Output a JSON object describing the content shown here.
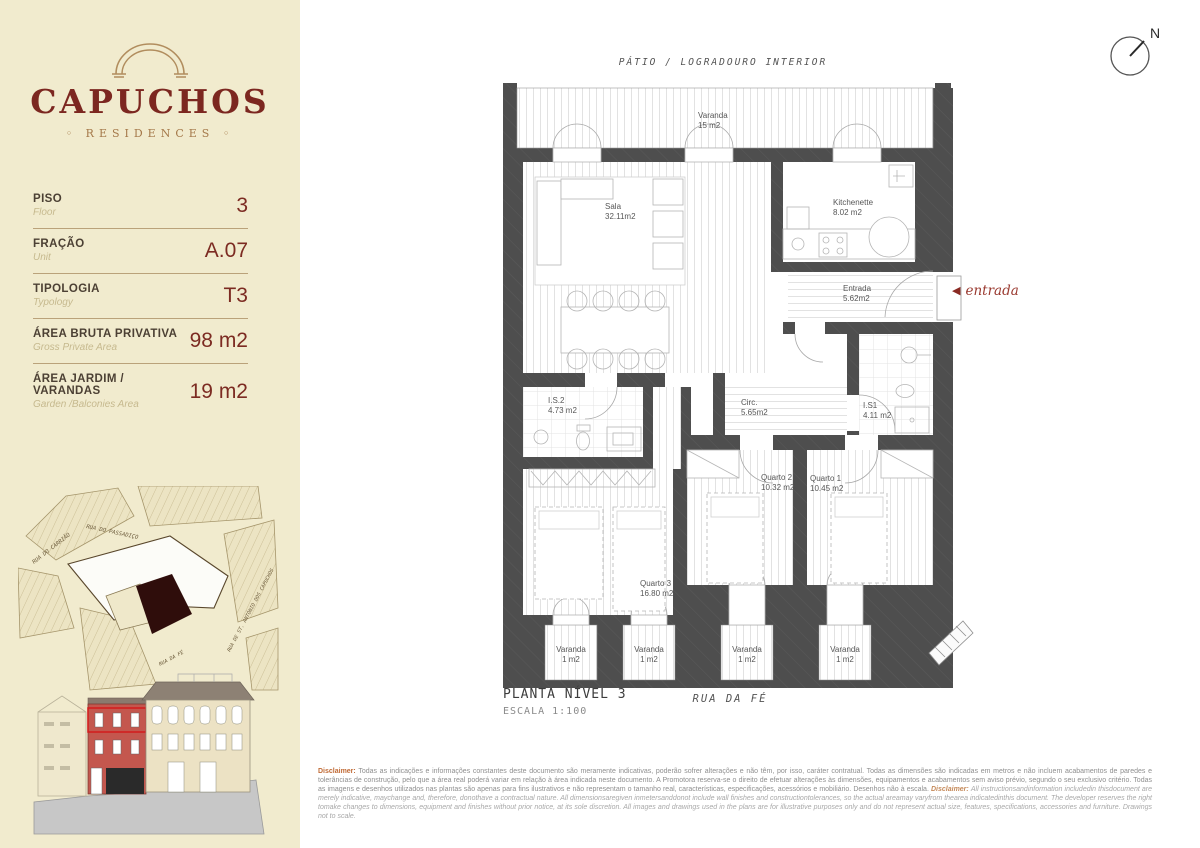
{
  "brand": {
    "name": "CAPUCHOS",
    "subtitle": "◦ RESIDENCES ◦"
  },
  "sidebar": {
    "fields": [
      {
        "label": "PISO",
        "sublabel": "Floor",
        "value": "3"
      },
      {
        "label": "FRAÇÃO",
        "sublabel": "Unit",
        "value": "A.07"
      },
      {
        "label": "TIPOLOGIA",
        "sublabel": "Typology",
        "value": "T3"
      },
      {
        "label": "ÁREA BRUTA PRIVATIVA",
        "sublabel": "Gross Private Area",
        "value": "98 m2"
      },
      {
        "label": "ÁREA JARDIM / VARANDAS",
        "sublabel": "Garden /Balconies Area",
        "value": "19 m2"
      }
    ],
    "map": {
      "streets": [
        "RUA DO CARRIÃO",
        "RUA DO PASSADIÇO",
        "RUA DE ST. ANTÓNIO DOS CAPUCHOS",
        "RUA DA FÉ"
      ]
    }
  },
  "plan": {
    "patio_label": "PÁTIO / LOGRADOURO INTERIOR",
    "street_label": "RUA DA FÉ",
    "title": "PLANTA NÍVEL 3",
    "scale": "ESCALA 1:100",
    "entrance_label": "entrada",
    "compass": "N",
    "rooms": [
      {
        "name": "Varanda",
        "area": "15 m2"
      },
      {
        "name": "Sala",
        "area": "32.11m2"
      },
      {
        "name": "Kitchenette",
        "area": "8.02 m2"
      },
      {
        "name": "Entrada",
        "area": "5.62m2"
      },
      {
        "name": "I.S.2",
        "area": "4.73 m2"
      },
      {
        "name": "Circ.",
        "area": "5.65m2"
      },
      {
        "name": "I.S1",
        "area": "4.11 m2"
      },
      {
        "name": "Quarto 2",
        "area": "10.32 m2"
      },
      {
        "name": "Quarto 1",
        "area": "10.45 m2"
      },
      {
        "name": "Quarto 3",
        "area": "16.80 m2"
      },
      {
        "name": "Varanda",
        "area": "1 m2"
      },
      {
        "name": "Varanda",
        "area": "1 m2"
      },
      {
        "name": "Varanda",
        "area": "1 m2"
      },
      {
        "name": "Varanda",
        "area": "1 m2"
      }
    ]
  },
  "disclaimer": {
    "label_pt": "Disclaimer:",
    "text_pt": "Todas as indicações e informações constantes deste documento são meramente indicativas, poderão sofrer alterações e não têm, por isso, caráter contratual. Todas as dimensões são indicadas em metros e não incluem acabamentos de paredes e tolerâncias de construção, pelo que a área real poderá variar em relação à área indicada neste documento. A Promotora reserva-se o direito de efetuar alterações às dimensões, equipamentos e acabamentos sem aviso prévio, segundo o seu exclusivo critério. Todas as imagens e desenhos utilizados nas plantas são apenas para fins ilustrativos e não representam o tamanho real, características, especificações, acessórios e mobiliário. Desenhos não à escala.",
    "label_en": "Disclaimer:",
    "text_en": "All instructionsandinformation includedin thisdocument are merely indicative, maychange and, therefore, donothave a contractual nature. All dimensionsaregiven inmetersanddonot include wall finishes and constructiontolerances, so the actual areamay varyfrom thearea indicatedinthis document. The developer reserves the right tomake changes to dimensions, equipment and finishes without prior notice, at its sole discretion. All images and drawings used in the plans are for illustrative purposes only and do not represent actual size, features, specifications, accessories and furniture. Drawings not to scale."
  },
  "colors": {
    "sidebar_bg": "#f1ebce",
    "brand_maroon": "#7c2720",
    "arch_tan": "#b18d5e",
    "wall_gray": "#4e4e4e",
    "map_building": "#2f0d0b",
    "elevation_red": "#c4574e"
  }
}
